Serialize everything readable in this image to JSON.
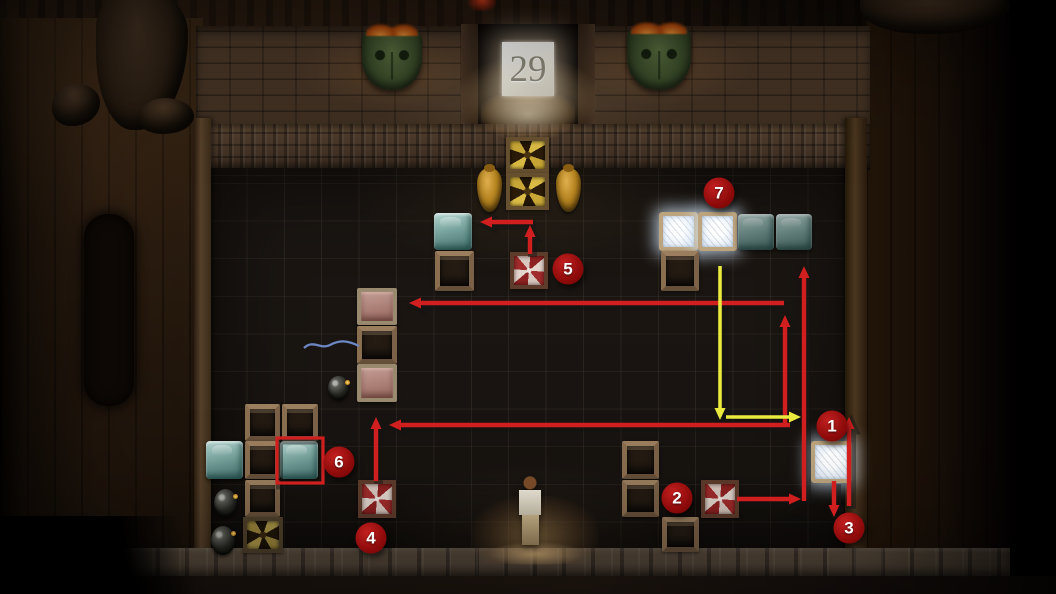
{
  "level": {
    "number": "29"
  },
  "colors": {
    "arrow_red": "#d11f1f",
    "arrow_yellow": "#e9e93e",
    "marker_fill": "#9c0d0d",
    "marker_text": "#ffffff",
    "highlight_red": "#d11f1f"
  },
  "markers": [
    {
      "label": "1",
      "x": 832,
      "y": 426
    },
    {
      "label": "2",
      "x": 677,
      "y": 498
    },
    {
      "label": "3",
      "x": 849,
      "y": 528
    },
    {
      "label": "4",
      "x": 371,
      "y": 538
    },
    {
      "label": "5",
      "x": 568,
      "y": 269
    },
    {
      "label": "6",
      "x": 339,
      "y": 462
    },
    {
      "label": "7",
      "x": 719,
      "y": 193
    }
  ],
  "arrows": [
    {
      "id": "step5-up",
      "color": "red",
      "points": [
        [
          530,
          254
        ],
        [
          530,
          225
        ]
      ]
    },
    {
      "id": "step5-left",
      "color": "red",
      "points": [
        [
          533,
          222
        ],
        [
          480,
          222
        ]
      ]
    },
    {
      "id": "step4-up",
      "color": "red",
      "points": [
        [
          376,
          481
        ],
        [
          376,
          417
        ]
      ]
    },
    {
      "id": "mid-run-left",
      "color": "red",
      "points": [
        [
          790,
          425
        ],
        [
          389,
          425
        ]
      ]
    },
    {
      "id": "right-climb-up",
      "color": "red",
      "points": [
        [
          785,
          426
        ],
        [
          785,
          315
        ]
      ]
    },
    {
      "id": "top-run-left",
      "color": "red",
      "points": [
        [
          784,
          303
        ],
        [
          409,
          303
        ]
      ]
    },
    {
      "id": "step2-right",
      "color": "red",
      "points": [
        [
          737,
          499
        ],
        [
          801,
          499
        ]
      ]
    },
    {
      "id": "wall-climb-up",
      "color": "red",
      "points": [
        [
          804,
          501
        ],
        [
          804,
          266
        ]
      ]
    },
    {
      "id": "step1-up",
      "color": "red",
      "points": [
        [
          849,
          506
        ],
        [
          849,
          417
        ]
      ]
    },
    {
      "id": "step3-down",
      "color": "red",
      "points": [
        [
          834,
          481
        ],
        [
          834,
          517
        ]
      ]
    },
    {
      "id": "bomb-drop-down",
      "color": "yellow",
      "points": [
        [
          720,
          266
        ],
        [
          720,
          420
        ]
      ]
    },
    {
      "id": "bomb-push-right",
      "color": "yellow",
      "points": [
        [
          726,
          417
        ],
        [
          801,
          417
        ]
      ]
    }
  ],
  "highlight_box": {
    "x": 277,
    "y": 438,
    "w": 46,
    "h": 45
  },
  "board": {
    "objects": [
      {
        "type": "mask",
        "x": 362,
        "y": 30,
        "w": 60,
        "h": 60
      },
      {
        "type": "mask",
        "x": 627,
        "y": 28,
        "w": 64,
        "h": 62
      },
      {
        "type": "fan",
        "x": 506,
        "y": 137,
        "w": 43,
        "h": 36
      },
      {
        "type": "fan",
        "x": 506,
        "y": 173,
        "w": 43,
        "h": 37
      },
      {
        "type": "pot",
        "x": 477,
        "y": 168,
        "w": 25,
        "h": 44
      },
      {
        "type": "pot",
        "x": 556,
        "y": 168,
        "w": 25,
        "h": 44
      },
      {
        "type": "ice-teal",
        "x": 434,
        "y": 213,
        "w": 38,
        "h": 37
      },
      {
        "type": "crate",
        "x": 435,
        "y": 251,
        "w": 39,
        "h": 40
      },
      {
        "type": "pinwheel",
        "x": 510,
        "y": 252,
        "w": 38,
        "h": 37
      },
      {
        "type": "ice-white",
        "x": 659,
        "y": 212,
        "w": 39,
        "h": 39
      },
      {
        "type": "ice-white",
        "x": 698,
        "y": 212,
        "w": 39,
        "h": 39
      },
      {
        "type": "ice-teal",
        "x": 738,
        "y": 214,
        "w": 36,
        "h": 36,
        "dim": true
      },
      {
        "type": "ice-teal",
        "x": 776,
        "y": 214,
        "w": 36,
        "h": 36,
        "dim": true
      },
      {
        "type": "crate",
        "x": 661,
        "y": 251,
        "w": 38,
        "h": 40
      },
      {
        "type": "pink",
        "x": 357,
        "y": 288,
        "w": 40,
        "h": 37
      },
      {
        "type": "crate",
        "x": 357,
        "y": 326,
        "w": 40,
        "h": 38
      },
      {
        "type": "pink",
        "x": 357,
        "y": 364,
        "w": 40,
        "h": 38
      },
      {
        "type": "string",
        "x": 303,
        "y": 337,
        "w": 58,
        "h": 16
      },
      {
        "type": "bomb",
        "x": 328,
        "y": 376,
        "w": 21,
        "h": 24
      },
      {
        "type": "crate",
        "x": 245,
        "y": 404,
        "w": 35,
        "h": 37
      },
      {
        "type": "crate",
        "x": 282,
        "y": 404,
        "w": 36,
        "h": 37
      },
      {
        "type": "ice-teal",
        "x": 206,
        "y": 441,
        "w": 37,
        "h": 38
      },
      {
        "type": "crate",
        "x": 245,
        "y": 441,
        "w": 35,
        "h": 38
      },
      {
        "type": "ice-teal",
        "x": 280,
        "y": 441,
        "w": 38,
        "h": 38
      },
      {
        "type": "crate",
        "x": 245,
        "y": 480,
        "w": 35,
        "h": 37
      },
      {
        "type": "bomb",
        "x": 214,
        "y": 489,
        "w": 23,
        "h": 28
      },
      {
        "type": "bomb",
        "x": 211,
        "y": 526,
        "w": 24,
        "h": 29
      },
      {
        "type": "fan",
        "x": 243,
        "y": 517,
        "w": 40,
        "h": 36,
        "dim": true
      },
      {
        "type": "pinwheel",
        "x": 358,
        "y": 480,
        "w": 38,
        "h": 38
      },
      {
        "type": "crate",
        "x": 622,
        "y": 441,
        "w": 37,
        "h": 38
      },
      {
        "type": "crate",
        "x": 622,
        "y": 480,
        "w": 37,
        "h": 37
      },
      {
        "type": "pinwheel",
        "x": 701,
        "y": 480,
        "w": 38,
        "h": 38
      },
      {
        "type": "crate",
        "x": 662,
        "y": 517,
        "w": 37,
        "h": 35
      },
      {
        "type": "ice-white",
        "x": 811,
        "y": 441,
        "w": 41,
        "h": 42
      },
      {
        "type": "character",
        "x": 512,
        "y": 476,
        "w": 36,
        "h": 76
      }
    ]
  }
}
